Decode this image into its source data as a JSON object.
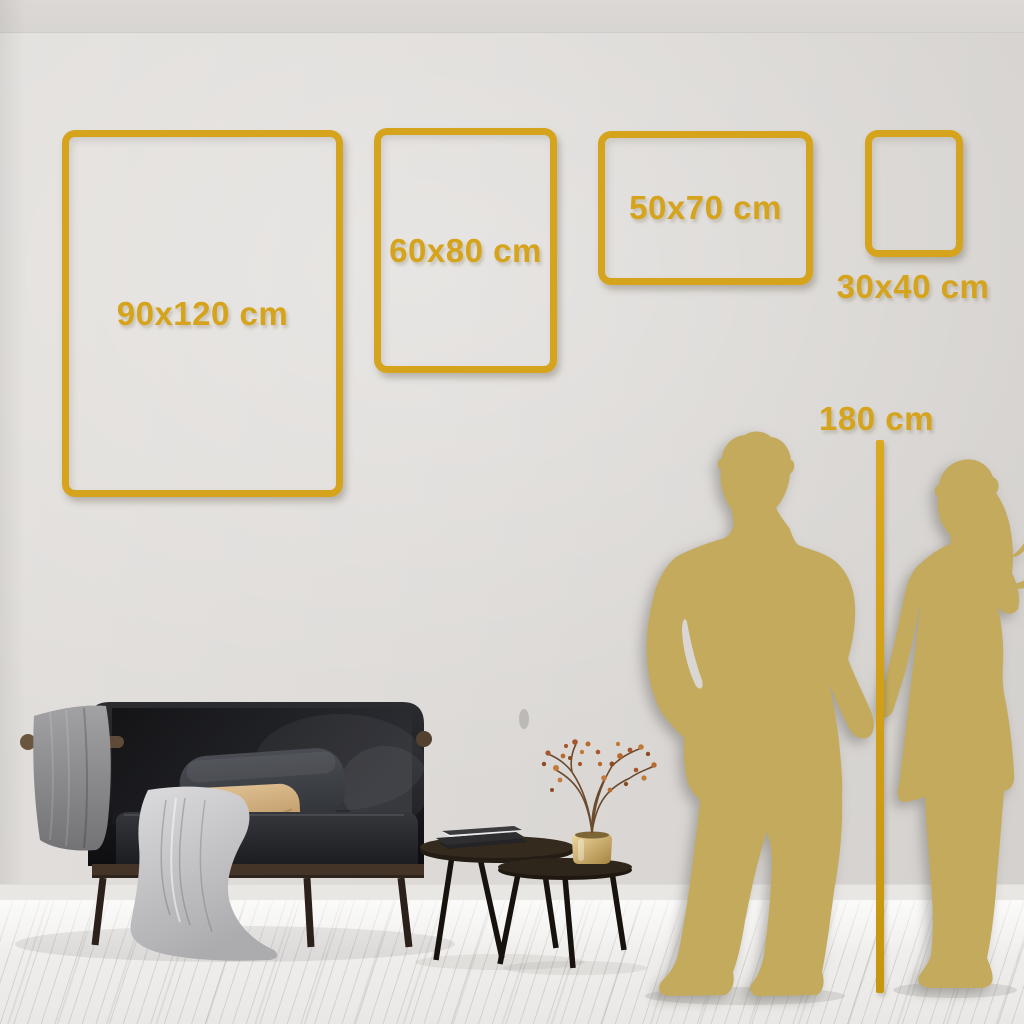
{
  "size_guide": {
    "frames": [
      {
        "id": "90x120",
        "label": "90x120 cm",
        "width_cm": 90,
        "height_cm": 120
      },
      {
        "id": "60x80",
        "label": "60x80 cm",
        "width_cm": 60,
        "height_cm": 80
      },
      {
        "id": "50x70",
        "label": "50x70 cm",
        "width_cm": 50,
        "height_cm": 70
      },
      {
        "id": "30x40",
        "label": "30x40 cm",
        "width_cm": 30,
        "height_cm": 40
      }
    ],
    "height_marker": {
      "label": "180 cm",
      "value_cm": 180
    }
  },
  "colors": {
    "accent_gold": "#D5A31C",
    "silhouette_gold": "#C3AA5C",
    "wall": "#DCD9D6",
    "floor": "#EFEDEB"
  },
  "scene": {
    "objects": [
      "sofa",
      "gray-throw-blanket",
      "draped-blanket",
      "dark-pillow",
      "tan-pillow",
      "nesting-coffee-tables",
      "book-stack",
      "brass-vase",
      "dried-berry-plant",
      "man-silhouette",
      "woman-silhouette",
      "height-reference-line"
    ]
  }
}
